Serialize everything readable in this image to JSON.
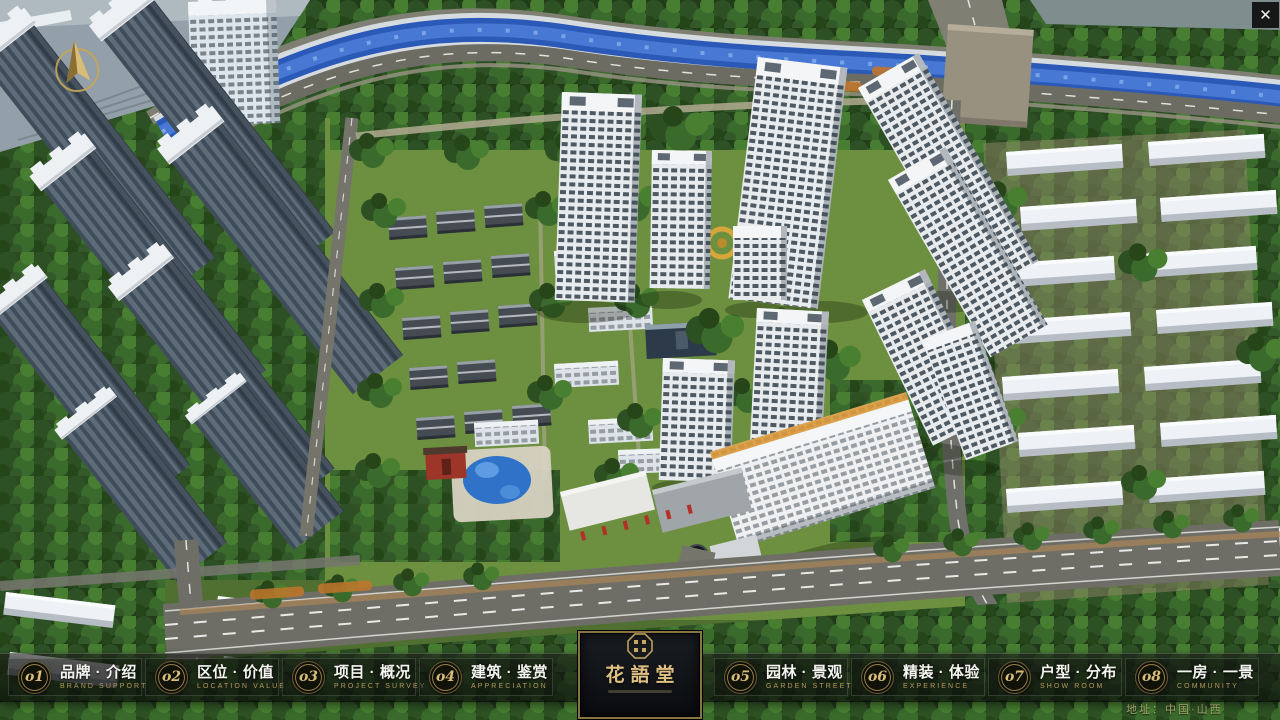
{
  "window": {
    "close_label": "✕"
  },
  "project": {
    "name_cn": "花語堂",
    "address": "地址：中国·山西"
  },
  "nav": {
    "items": [
      {
        "num": "o1",
        "cn": "品牌 · 介绍",
        "en": "BRAND SUPPORT"
      },
      {
        "num": "o2",
        "cn": "区位 · 价值",
        "en": "LOCATION VALUE"
      },
      {
        "num": "o3",
        "cn": "项目 · 概况",
        "en": "PROJECT SURVEY"
      },
      {
        "num": "o4",
        "cn": "建筑 · 鉴赏",
        "en": "APPRECIATION"
      },
      {
        "num": "o5",
        "cn": "园林 · 景观",
        "en": "GARDEN STREET"
      },
      {
        "num": "o6",
        "cn": "精装 · 体验",
        "en": "EXPERIENCE"
      },
      {
        "num": "o7",
        "cn": "户型 · 分布",
        "en": "SHOW ROOM"
      },
      {
        "num": "o8",
        "cn": "一房 · 一景",
        "en": "COMMUNITY"
      }
    ]
  },
  "colors": {
    "gold_accent": "#c2a35f",
    "nav_bg": "rgba(10,12,10,0.6)",
    "river_blue": "#2b59b8",
    "tree_green": "#3a6a2c",
    "lawn_green": "#6d9040",
    "entrance_red": "#b23028"
  }
}
